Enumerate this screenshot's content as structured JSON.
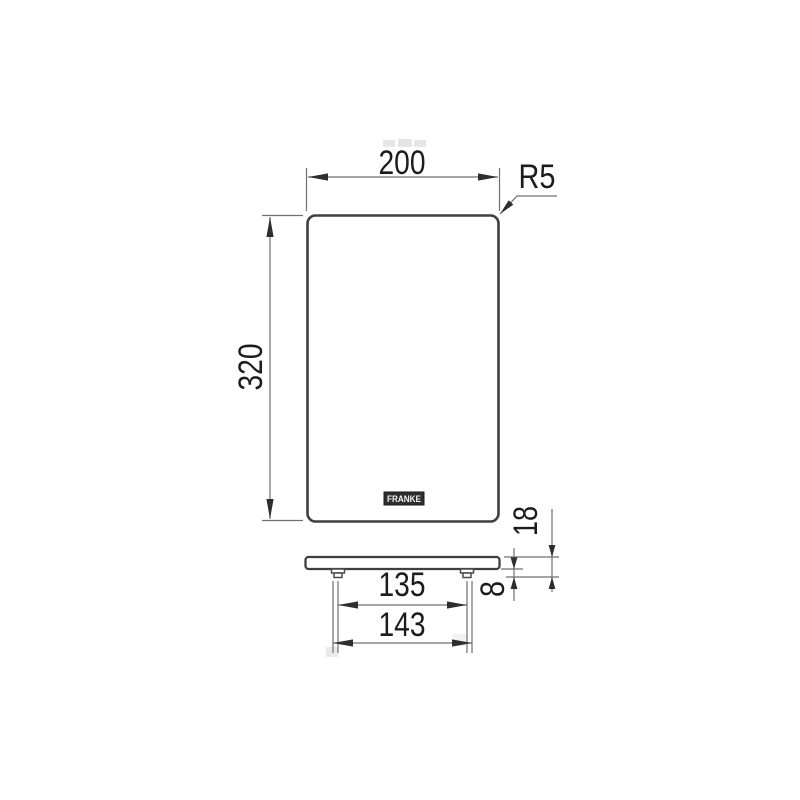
{
  "front_view": {
    "width_label": "200",
    "height_label": "320",
    "corner_radius_label": "R5",
    "logo_text": "FRANKE"
  },
  "side_view": {
    "overall_height_label": "18",
    "foot_height_label": "8",
    "foot_center_spacing_label": "135",
    "foot_outer_spacing_label": "143"
  },
  "colors": {
    "object_line": "#3f3f3f",
    "dimension_line": "#6f6f6f",
    "arrow_fill": "#2e2e2e",
    "text": "#1c1c1c",
    "logo_fill": "#2f2f2f",
    "background": "#ffffff"
  }
}
